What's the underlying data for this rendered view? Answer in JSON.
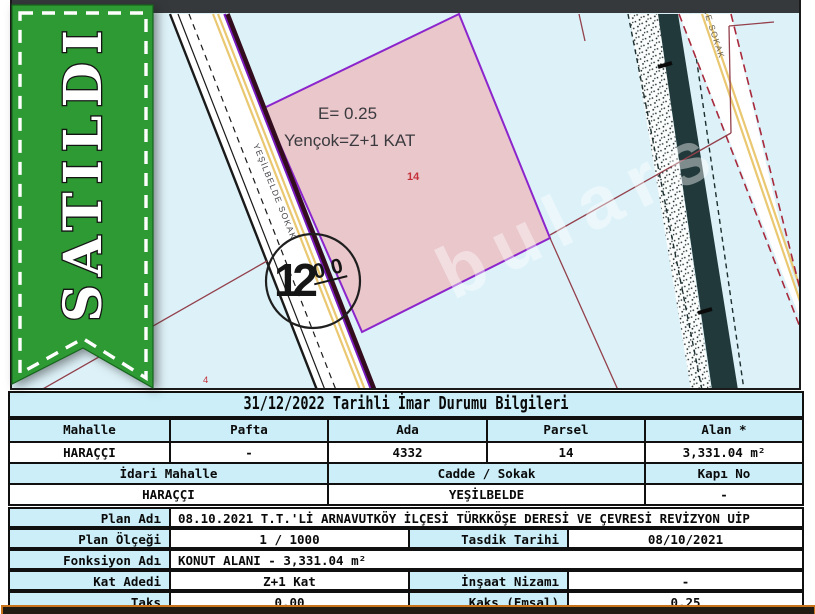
{
  "ribbon": {
    "label": "SATILDI"
  },
  "map": {
    "zone_note_line1": "E= 0.25",
    "zone_note_line2": "Yençok=Z+1 KAT",
    "parcel_label": "14",
    "neighbor_parcel_label": "4",
    "road_width": "12",
    "road_width_sup": "00",
    "street_label_1": "YEŞİLBELDE SOKAK",
    "street_label_2": "CE SOKAK",
    "watermark": "bulars",
    "colors": {
      "background": "#ddf2f8",
      "parcel_fill": "#e9c7cb",
      "parcel_border": "#8c25cc",
      "road_yellow": "#eac871",
      "stream": "#21393a",
      "red_dashed": "#a8293c",
      "cadastral_line": "#93404c",
      "ribbon_green": "#2e9a33"
    }
  },
  "table": {
    "title": "31/12/2022 Tarihli İmar Durumu Bilgileri",
    "parcel_header": [
      "Mahalle",
      "Pafta",
      "Ada",
      "Parsel",
      "Alan *"
    ],
    "parcel_values": [
      "HARAÇÇI",
      "-",
      "4332",
      "14",
      "3,331.04 m²"
    ],
    "address_header": [
      "İdari Mahalle",
      "Cadde / Sokak",
      "Kapı No"
    ],
    "address_values": [
      "HARAÇÇI",
      "YEŞİLBELDE",
      "-"
    ],
    "plan_rows": [
      {
        "label": "Plan Adı",
        "value": "08.10.2021 T.T.'Lİ ARNAVUTKÖY İLÇESİ TÜRKKÖŞE DERESİ VE ÇEVRESİ REVİZYON UİP"
      },
      {
        "label": "Plan Ölçeği",
        "value": "1 / 1000",
        "label2": "Tasdik Tarihi",
        "value2": "08/10/2021"
      },
      {
        "label": "Fonksiyon Adı",
        "value": "KONUT ALANI - 3,331.04 m²"
      },
      {
        "label": "Kat Adedi",
        "value": "Z+1 Kat",
        "label2": "İnşaat Nizamı",
        "value2": "-"
      },
      {
        "label": "Taks",
        "value": "0.00",
        "label2": "Kaks (Emsal)",
        "value2": "0.25"
      }
    ]
  }
}
